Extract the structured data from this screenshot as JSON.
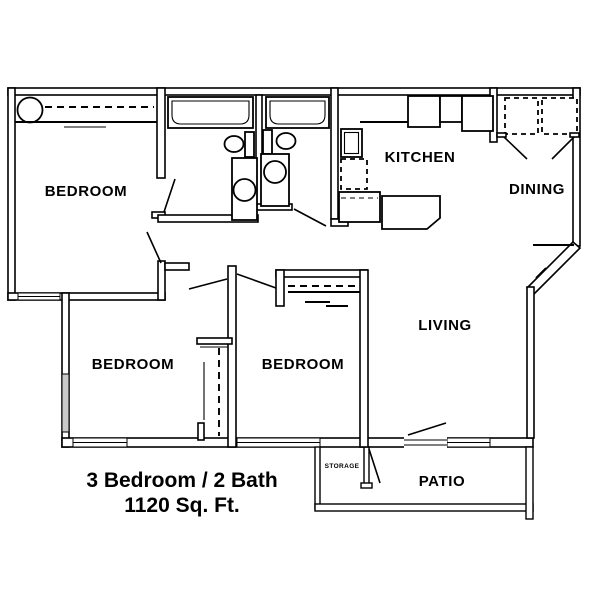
{
  "caption": {
    "line1": "3 Bedroom / 2 Bath",
    "line2": "1120 Sq. Ft."
  },
  "rooms": {
    "bedroom1": {
      "label": "BEDROOM"
    },
    "bedroom2": {
      "label": "BEDROOM"
    },
    "bedroom3": {
      "label": "BEDROOM"
    },
    "kitchen": {
      "label": "KITCHEN"
    },
    "dining": {
      "label": "DINING"
    },
    "living": {
      "label": "LIVING"
    },
    "patio": {
      "label": "PATIO"
    },
    "storage": {
      "label": "STORAGE"
    }
  },
  "fixtures": {
    "water_heater": "water-heater",
    "closet_rod": "closet-rod",
    "bathtub": "bathtub",
    "toilet": "toilet",
    "vanity_sink": "vanity-sink",
    "kitchen_sink": "kitchen-sink",
    "dishwasher": "dishwasher",
    "refrigerator": "refrigerator",
    "range": "range",
    "washer_dryer": "washer-dryer",
    "breakfast_bar": "breakfast-bar"
  },
  "colors": {
    "background": "#ffffff",
    "walls": "#000000",
    "text": "#000000"
  }
}
